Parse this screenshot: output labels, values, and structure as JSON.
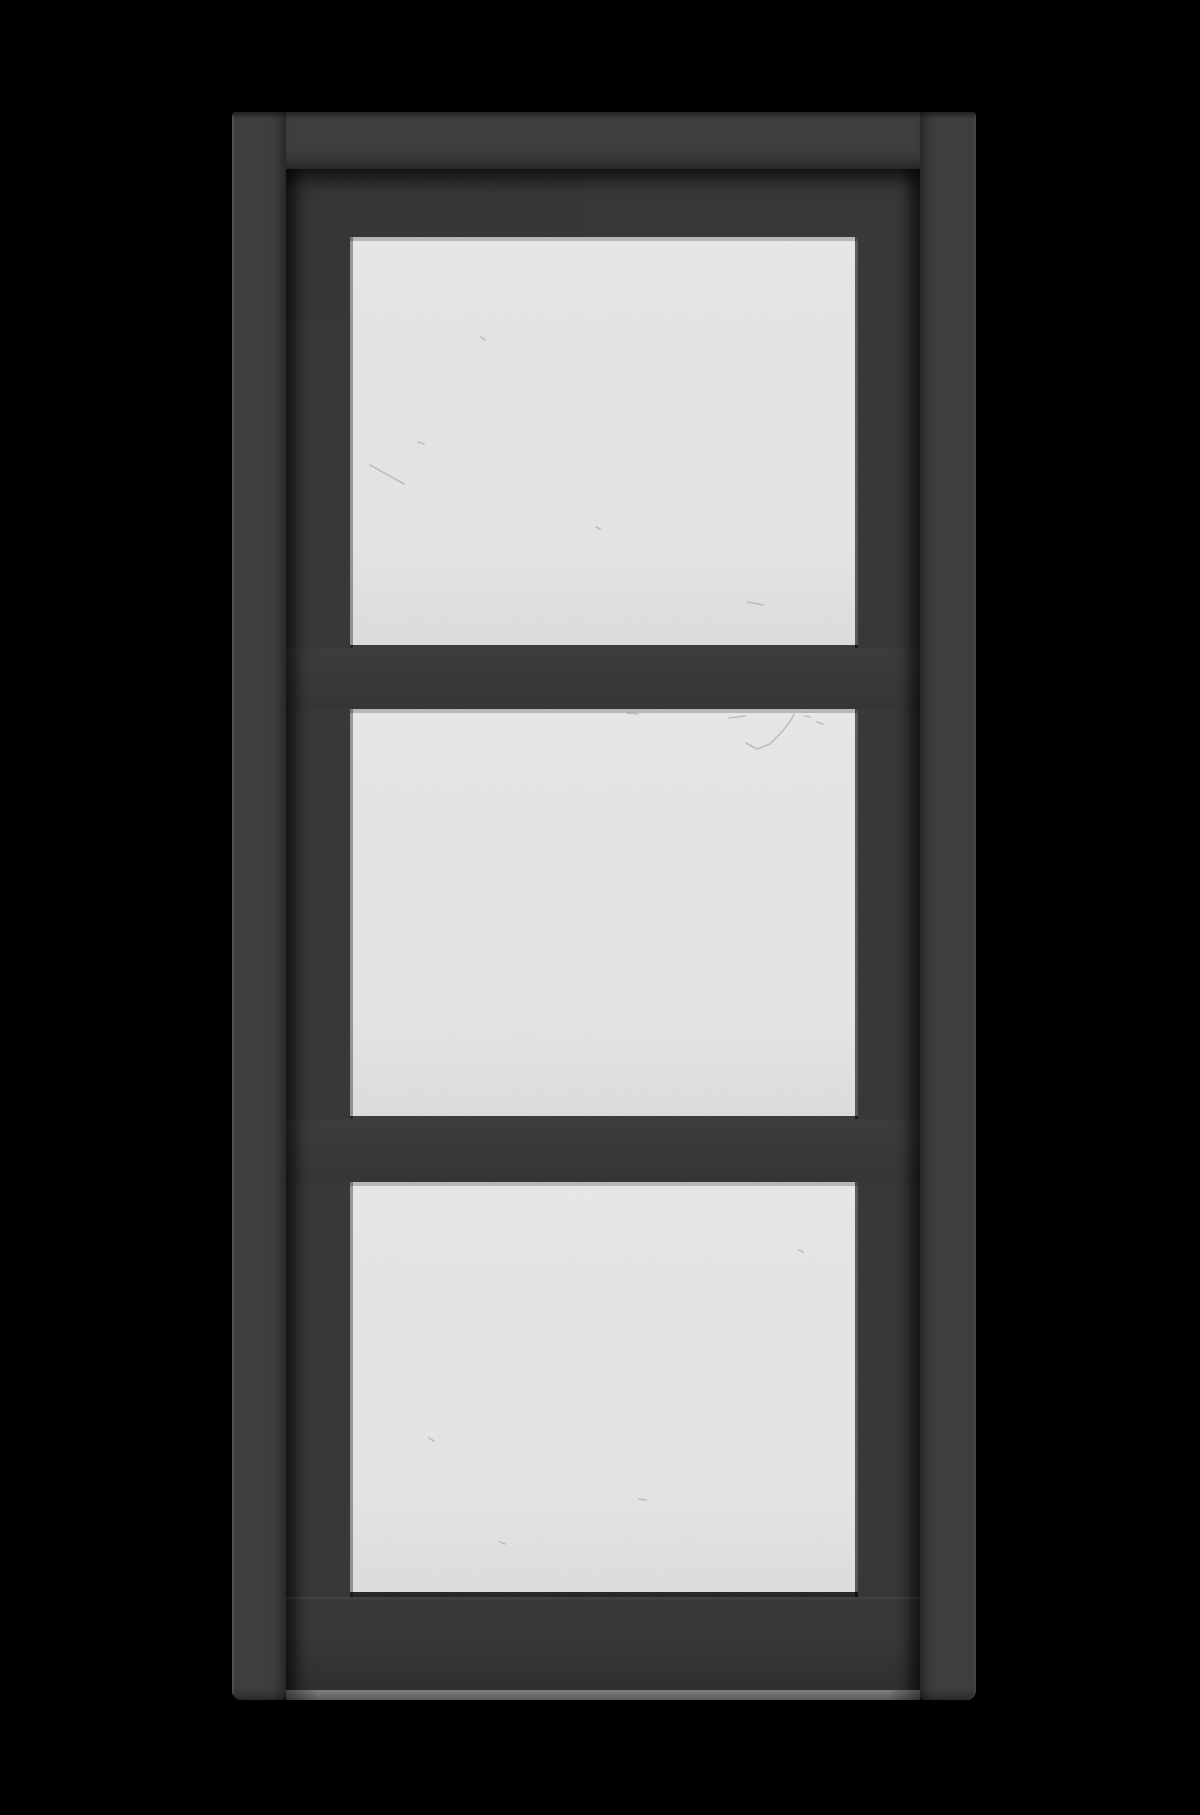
{
  "scene": {
    "description": "Studio render of a charcoal-gray three-lite glass panel door centered on a black background",
    "object": "three-lite-glass-door",
    "panel_count": 3,
    "panels": [
      {
        "id": "top",
        "label": "upper glass lite"
      },
      {
        "id": "middle",
        "label": "middle glass lite"
      },
      {
        "id": "bottom",
        "label": "lower glass lite"
      }
    ],
    "colors": {
      "background": "#000000",
      "frame": "#3e3e3e",
      "slab": "#383838",
      "seam_shadow": "#1f1f1f",
      "glass": "#eaeaea",
      "glass_bevel": "#bdbdbd",
      "glass_edge_dark": "#2a2a2a",
      "bottom_edge_highlight": "#6f6f6f",
      "scratch": "#8f8f8f"
    },
    "defects": {
      "panel1": "M20,228 l34,19 M131,100 l4,3 M246,290 l4,2 M398,365 l15,3 M68,205 l6,2",
      "panel2": "M444,5 C440,15 431,24 420,35 L407,40 L396,34 M379,9 l16,-2 M455,7 l5,1 M467,13 l6,2 M277,4 l11,1",
      "panel3": "M79,256 l5,3 M289,317 l7,1 M449,68 l4,2 M150,360 l5,2"
    }
  }
}
